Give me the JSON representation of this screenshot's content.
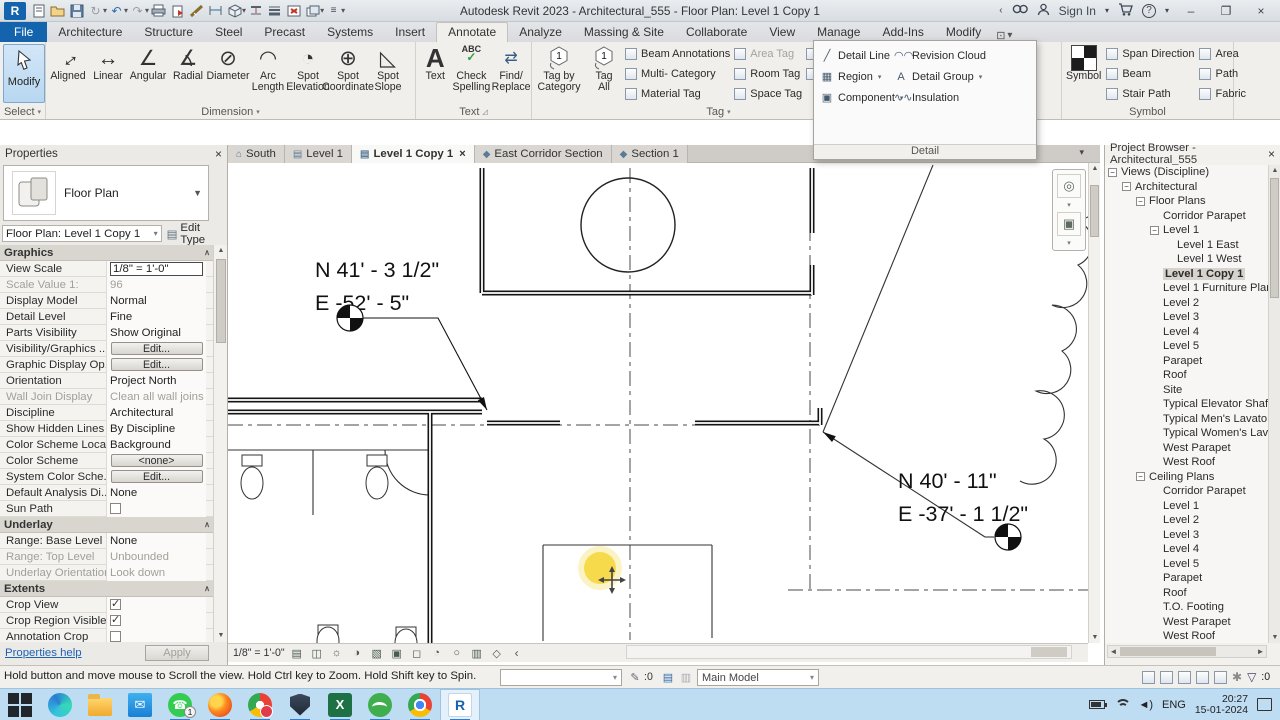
{
  "window": {
    "title": "Autodesk Revit 2023 - Architectural_555 - Floor Plan: Level 1 Copy 1",
    "sign_in": "Sign In",
    "minimize": "–",
    "maximize": "❐",
    "close": "×"
  },
  "ribbon": {
    "tabs": [
      {
        "label": "File",
        "file": true,
        "name": "tab-file"
      },
      {
        "label": "Architecture",
        "name": "tab-architecture"
      },
      {
        "label": "Structure",
        "name": "tab-structure"
      },
      {
        "label": "Steel",
        "name": "tab-steel"
      },
      {
        "label": "Precast",
        "name": "tab-precast"
      },
      {
        "label": "Systems",
        "name": "tab-systems"
      },
      {
        "label": "Insert",
        "name": "tab-insert"
      },
      {
        "label": "Annotate",
        "active": true,
        "name": "tab-annotate"
      },
      {
        "label": "Analyze",
        "name": "tab-analyze"
      },
      {
        "label": "Massing & Site",
        "name": "tab-massing-site"
      },
      {
        "label": "Collaborate",
        "name": "tab-collaborate"
      },
      {
        "label": "View",
        "name": "tab-view"
      },
      {
        "label": "Manage",
        "name": "tab-manage"
      },
      {
        "label": "Add-Ins",
        "name": "tab-add-ins"
      },
      {
        "label": "Modify",
        "name": "tab-modify"
      }
    ],
    "select_panel": {
      "modify": "Modify",
      "label": "Select"
    },
    "dimension_panel": {
      "label": "Dimension",
      "tools": [
        {
          "l1": "Aligned",
          "l2": "",
          "glyph": "↔",
          "rot": true,
          "name": "aligned-dimension-tool"
        },
        {
          "l1": "Linear",
          "l2": "",
          "glyph": "↔",
          "name": "linear-dimension-tool"
        },
        {
          "l1": "Angular",
          "l2": "",
          "glyph": "∠",
          "name": "angular-dimension-tool"
        },
        {
          "l1": "Radial",
          "l2": "",
          "glyph": "∡",
          "name": "radial-dimension-tool"
        },
        {
          "l1": "Diameter",
          "l2": "",
          "glyph": "⊘",
          "name": "diameter-dimension-tool"
        },
        {
          "l1": "Arc",
          "l2": "Length",
          "glyph": "◠",
          "name": "arc-length-tool"
        },
        {
          "l1": "Spot",
          "l2": "Elevation",
          "glyph": "◔",
          "name": "spot-elevation-tool"
        },
        {
          "l1": "Spot",
          "l2": "Coordinate",
          "glyph": "⊕",
          "name": "spot-coordinate-tool"
        },
        {
          "l1": "Spot",
          "l2": "Slope",
          "glyph": "◺",
          "name": "spot-slope-tool"
        }
      ]
    },
    "text_panel": {
      "label": "Text",
      "text_tool": "Text",
      "check1": "Check",
      "check2": "Spelling",
      "find1": "Find/",
      "find2": "Replace"
    },
    "tag_panel": {
      "label": "Tag",
      "tag_by_1": "Tag by",
      "tag_by_2": "Category",
      "tag_all_1": "Tag",
      "tag_all_2": "All",
      "col_a": [
        {
          "label": "Beam Annotations",
          "name": "beam-annotations-tool"
        },
        {
          "label": "Multi- Category",
          "name": "multi-category-tag-tool"
        },
        {
          "label": "Material Tag",
          "name": "material-tag-tool"
        }
      ],
      "col_b": [
        {
          "label": "Area Tag",
          "dim": true,
          "name": "area-tag-tool"
        },
        {
          "label": "Room Tag",
          "name": "room-tag-tool"
        },
        {
          "label": "Space Tag",
          "name": "space-tag-tool"
        }
      ],
      "col_c": [
        {
          "label": "View Reference",
          "name": "view-reference-tool"
        },
        {
          "label": "Tread Number",
          "name": "tread-number-tool"
        }
      ]
    },
    "colorfill_panel": {
      "label": "or Fill",
      "items": [
        {
          "label": "Duct Legend",
          "name": "duct-legend-tool"
        },
        {
          "label": "Pipe Legend",
          "name": "pipe-legend-tool"
        },
        {
          "label": "Fill Legend",
          "name": "color-fill-legend-tool"
        }
      ]
    },
    "symbol_panel": {
      "label": "Symbol",
      "big": "Symbol",
      "col1": [
        {
          "label": "Span Direction",
          "name": "span-direction-tool"
        },
        {
          "label": "Beam",
          "name": "beam-symbol-tool"
        },
        {
          "label": "Stair Path",
          "name": "stair-path-tool"
        }
      ],
      "col2": [
        {
          "label": "Area",
          "name": "area-symbol-tool"
        },
        {
          "label": "Path",
          "name": "path-symbol-tool"
        },
        {
          "label": "Fabric",
          "name": "fabric-symbol-tool"
        }
      ]
    }
  },
  "flyout": {
    "label": "Detail",
    "left": [
      {
        "label": "Detail Line",
        "glyph": "╱",
        "name": "detail-line-tool"
      },
      {
        "label": "Region",
        "glyph": "▦",
        "dd": true,
        "name": "region-tool"
      },
      {
        "label": "Component",
        "glyph": "▣",
        "dd": true,
        "name": "detail-component-tool"
      }
    ],
    "right": [
      {
        "label": "Revision Cloud",
        "glyph": "◠◠",
        "name": "revision-cloud-tool"
      },
      {
        "label": "Detail Group",
        "glyph": "A",
        "dd": true,
        "name": "detail-group-tool"
      },
      {
        "label": "Insulation",
        "glyph": "∿∿",
        "name": "insulation-tool"
      }
    ]
  },
  "properties": {
    "title": "Properties",
    "type_name": "Floor Plan",
    "instance": "Floor Plan: Level 1 Copy 1",
    "edit_type": "Edit Type",
    "rows": [
      {
        "header": "Graphics"
      },
      {
        "label": "View Scale",
        "input": "1/8\" = 1'-0\""
      },
      {
        "label": "Scale Value   1:",
        "text": "96",
        "dim": true
      },
      {
        "label": "Display Model",
        "text": "Normal"
      },
      {
        "label": "Detail Level",
        "text": "Fine"
      },
      {
        "label": "Parts Visibility",
        "text": "Show Original"
      },
      {
        "label": "Visibility/Graphics ...",
        "btn": "Edit..."
      },
      {
        "label": "Graphic Display Op...",
        "btn": "Edit..."
      },
      {
        "label": "Orientation",
        "text": "Project North"
      },
      {
        "label": "Wall Join Display",
        "text": "Clean all wall joins",
        "dim": true
      },
      {
        "label": "Discipline",
        "text": "Architectural"
      },
      {
        "label": "Show Hidden Lines",
        "text": "By Discipline"
      },
      {
        "label": "Color Scheme Loca...",
        "text": "Background"
      },
      {
        "label": "Color Scheme",
        "btn": "<none>"
      },
      {
        "label": "System Color Sche...",
        "btn": "Edit..."
      },
      {
        "label": "Default Analysis Di...",
        "text": "None"
      },
      {
        "label": "Sun Path",
        "check": true,
        "checked": false
      },
      {
        "header": "Underlay"
      },
      {
        "label": "Range: Base Level",
        "text": "None"
      },
      {
        "label": "Range: Top Level",
        "text": "Unbounded",
        "dim": true
      },
      {
        "label": "Underlay Orientation",
        "text": "Look down",
        "dim": true
      },
      {
        "header": "Extents"
      },
      {
        "label": "Crop View",
        "check": true,
        "checked": true
      },
      {
        "label": "Crop Region Visible",
        "check": true,
        "checked": true
      },
      {
        "label": "Annotation Crop",
        "check": true,
        "checked": false
      }
    ],
    "help_link": "Properties help",
    "apply": "Apply"
  },
  "view_tabs": [
    {
      "label": "South",
      "icon": "⌂",
      "name": "view-tab-south"
    },
    {
      "label": "Level 1",
      "icon": "▤",
      "name": "view-tab-level-1"
    },
    {
      "label": "Level 1 Copy 1",
      "icon": "▤",
      "active": true,
      "name": "view-tab-level-1-copy-1"
    },
    {
      "label": "East Corridor Section",
      "icon": "◆",
      "name": "view-tab-east-corridor-section"
    },
    {
      "label": "Section 1",
      "icon": "◆",
      "name": "view-tab-section-1"
    }
  ],
  "canvas": {
    "spot1_line1": "N 41' - 3 1/2\"",
    "spot1_line2": "E -52' - 5\"",
    "spot2_line1": "N 40' - 11\"",
    "spot2_line2": "E -37' - 1 1/2\""
  },
  "view_bar": {
    "scale": "1/8\" = 1'-0\""
  },
  "project_browser": {
    "title": "Project Browser - Architectural_555",
    "tree": [
      {
        "label": "Views (Discipline)",
        "depth": 0,
        "exp": true,
        "name": "node-views-discipline"
      },
      {
        "label": "Architectural",
        "depth": 1,
        "exp": true,
        "name": "node-architectural"
      },
      {
        "label": "Floor Plans",
        "depth": 2,
        "exp": true,
        "name": "node-floor-plans"
      },
      {
        "label": "Corridor Parapet",
        "depth": 3,
        "leaf": true
      },
      {
        "label": "Level 1",
        "depth": 3,
        "exp": true
      },
      {
        "label": "Level 1 East",
        "depth": 4,
        "leaf": true
      },
      {
        "label": "Level 1 West",
        "depth": 4,
        "leaf": true
      },
      {
        "label": "Level 1 Copy 1",
        "depth": 3,
        "leaf": true,
        "sel": true
      },
      {
        "label": "Level 1 Furniture Plan",
        "depth": 3,
        "leaf": true
      },
      {
        "label": "Level 2",
        "depth": 3,
        "leaf": true
      },
      {
        "label": "Level 3",
        "depth": 3,
        "leaf": true
      },
      {
        "label": "Level 4",
        "depth": 3,
        "leaf": true
      },
      {
        "label": "Level 5",
        "depth": 3,
        "leaf": true
      },
      {
        "label": "Parapet",
        "depth": 3,
        "leaf": true
      },
      {
        "label": "Roof",
        "depth": 3,
        "leaf": true
      },
      {
        "label": "Site",
        "depth": 3,
        "leaf": true
      },
      {
        "label": "Typical Elevator Shaf",
        "depth": 3,
        "leaf": true
      },
      {
        "label": "Typical Men's Lavato",
        "depth": 3,
        "leaf": true
      },
      {
        "label": "Typical Women's Lav",
        "depth": 3,
        "leaf": true
      },
      {
        "label": "West Parapet",
        "depth": 3,
        "leaf": true
      },
      {
        "label": "West Roof",
        "depth": 3,
        "leaf": true
      },
      {
        "label": "Ceiling Plans",
        "depth": 2,
        "exp": true,
        "name": "node-ceiling-plans"
      },
      {
        "label": "Corridor Parapet",
        "depth": 3,
        "leaf": true
      },
      {
        "label": "Level 1",
        "depth": 3,
        "leaf": true
      },
      {
        "label": "Level 2",
        "depth": 3,
        "leaf": true
      },
      {
        "label": "Level 3",
        "depth": 3,
        "leaf": true
      },
      {
        "label": "Level 4",
        "depth": 3,
        "leaf": true
      },
      {
        "label": "Level 5",
        "depth": 3,
        "leaf": true
      },
      {
        "label": "Parapet",
        "depth": 3,
        "leaf": true
      },
      {
        "label": "Roof",
        "depth": 3,
        "leaf": true
      },
      {
        "label": "T.O. Footing",
        "depth": 3,
        "leaf": true
      },
      {
        "label": "West Parapet",
        "depth": 3,
        "leaf": true
      },
      {
        "label": "West Roof",
        "depth": 3,
        "leaf": true
      }
    ]
  },
  "status_bar": {
    "hint": "Hold button and move mouse to Scroll the view. Hold Ctrl key to Zoom. Hold Shift key to Spin.",
    "editable_count": ":0",
    "main_model": "Main Model",
    "filter_count": ":0"
  },
  "taskbar": {
    "apps": [
      {
        "kind": "win",
        "name": "start-button"
      },
      {
        "kind": "edge",
        "name": "edge-app"
      },
      {
        "kind": "folder",
        "name": "file-explorer-app"
      },
      {
        "kind": "mail",
        "name": "mail-app",
        "glyph": "✉"
      },
      {
        "kind": "whatsapp",
        "name": "whatsapp-app",
        "glyph": "☎",
        "badge": "1",
        "running": true
      },
      {
        "kind": "firefox",
        "name": "firefox-app",
        "running": true
      },
      {
        "kind": "opera",
        "name": "browser-notification-app",
        "running": true
      },
      {
        "kind": "defender",
        "name": "defender-app",
        "running": true
      },
      {
        "kind": "excel",
        "name": "excel-app",
        "glyph": "X",
        "running": true
      },
      {
        "kind": "green",
        "name": "capture-app",
        "running": true
      },
      {
        "kind": "chrome",
        "name": "chrome-app",
        "running": true
      },
      {
        "kind": "revit",
        "name": "revit-app",
        "glyph": "R",
        "running": true,
        "active": true
      }
    ],
    "lang": "ENG",
    "time": "20:27",
    "date": "15-01-2024"
  }
}
